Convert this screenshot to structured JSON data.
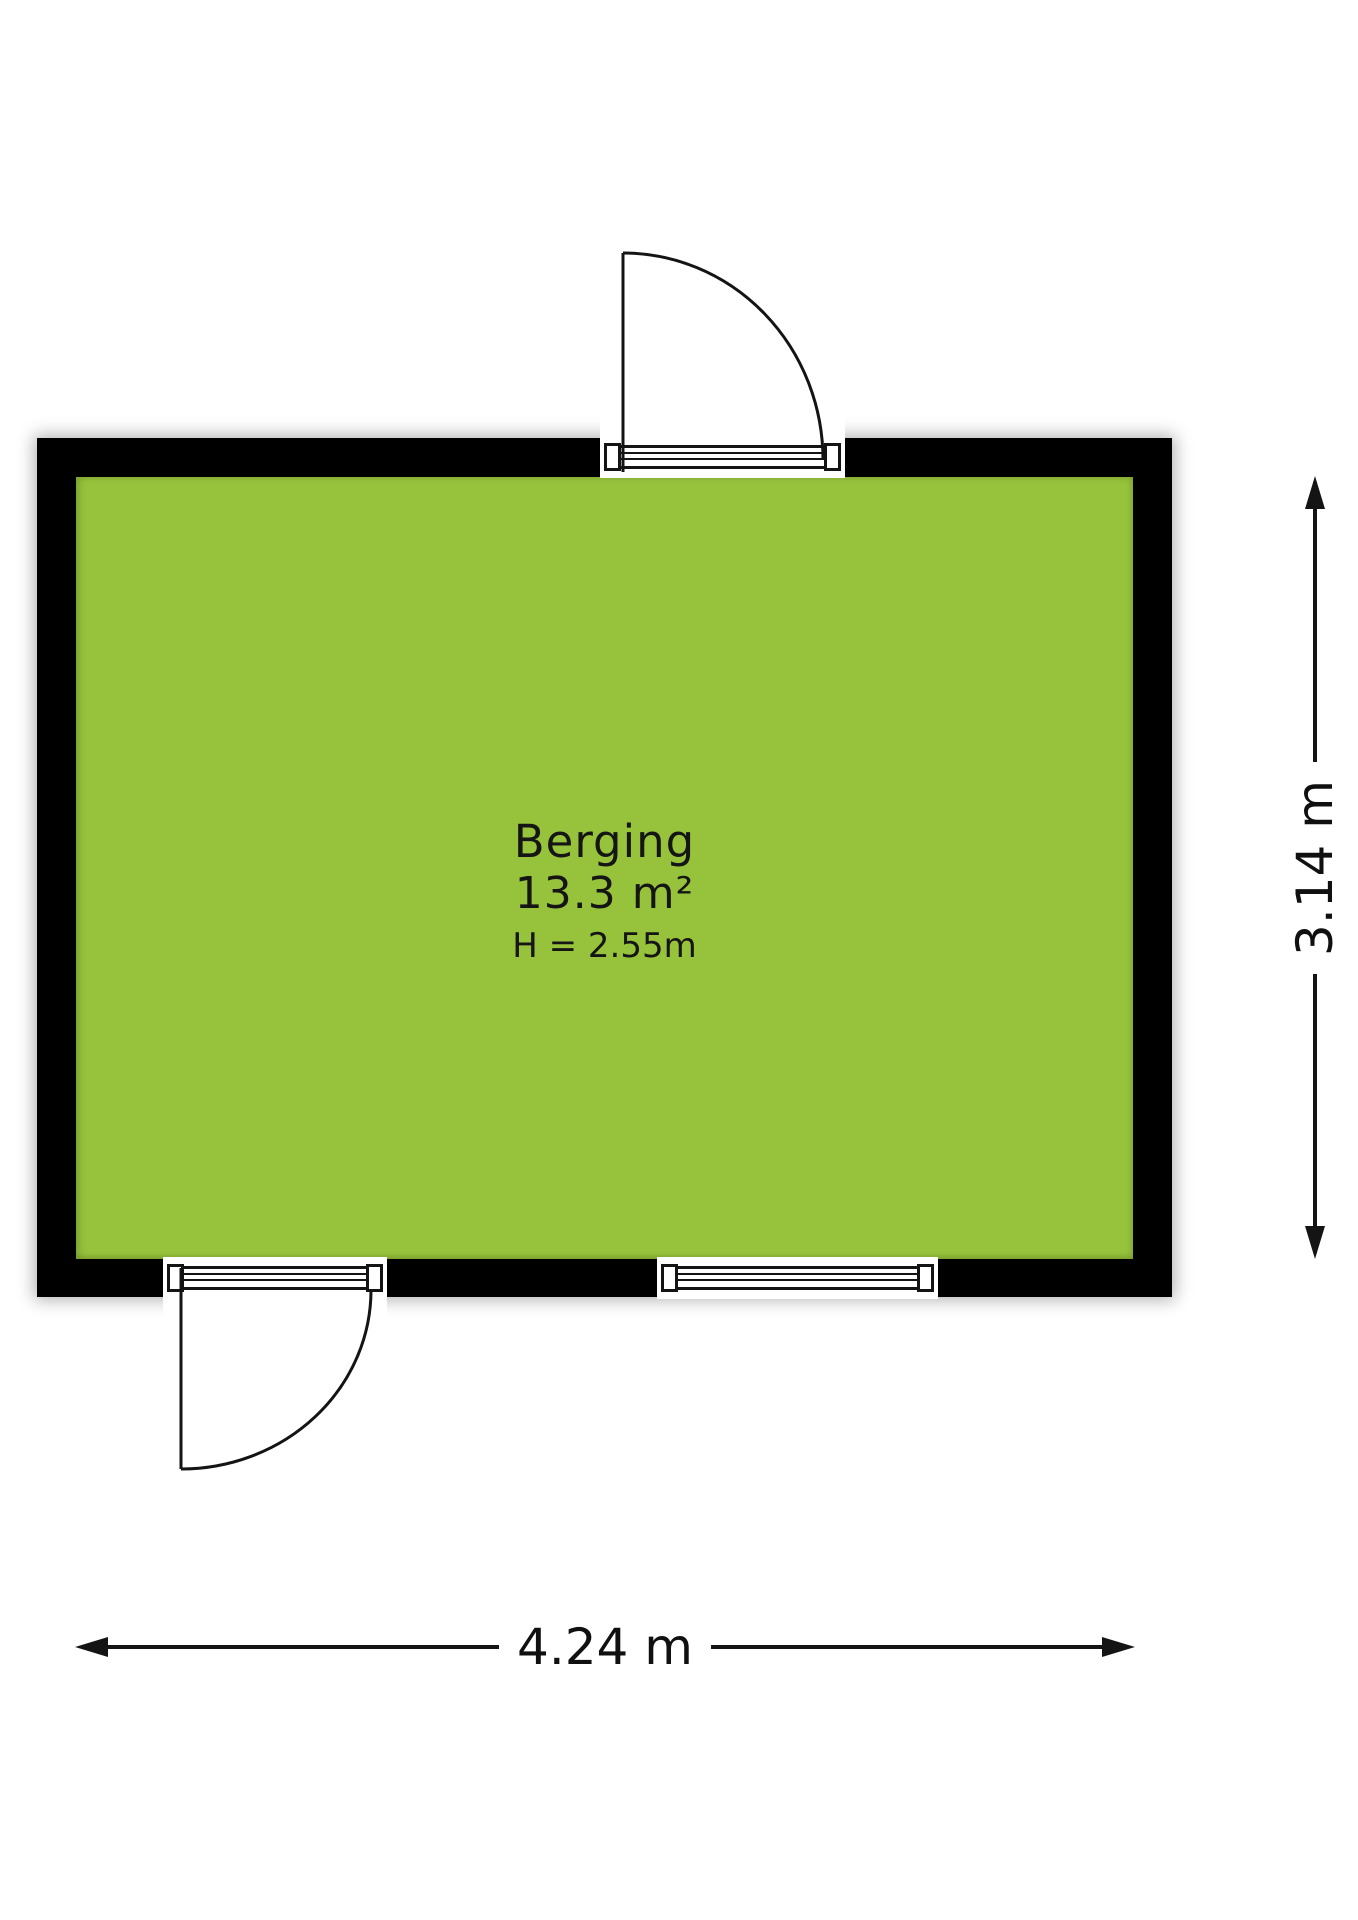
{
  "room": {
    "name": "Berging",
    "area": "13.3 m²",
    "ceiling_height": "H = 2.55m"
  },
  "dimensions": {
    "width_label": "4.24 m",
    "height_label": "3.14 m"
  },
  "colors": {
    "floor_fill": "#97c33c",
    "wall_color": "#000000",
    "line_color": "#141414"
  }
}
